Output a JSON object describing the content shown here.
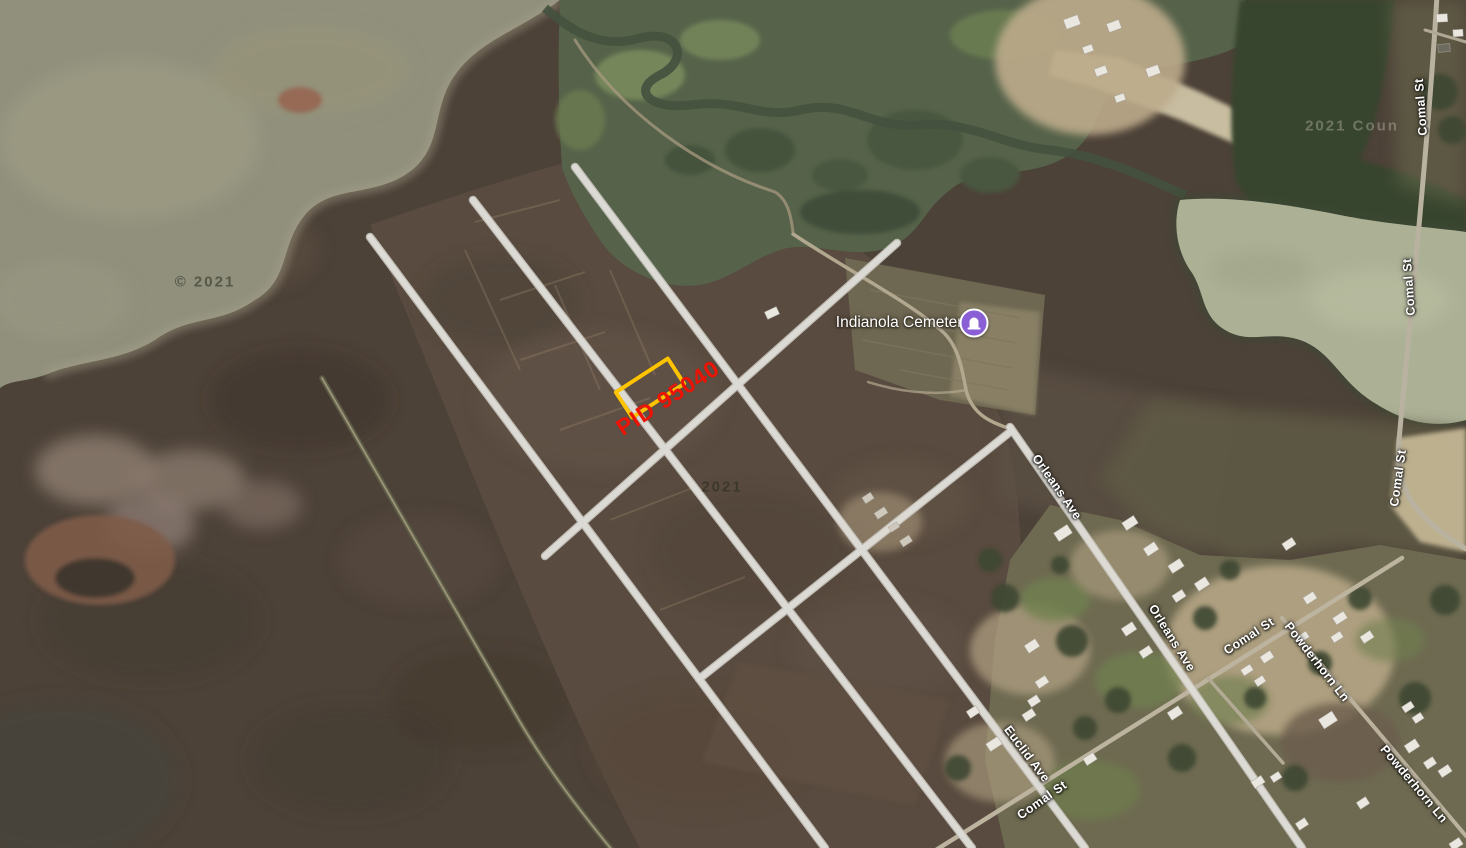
{
  "map": {
    "view": "satellite",
    "parcel": {
      "pid_label": "PID 95040",
      "outline_color": "#ffc400",
      "label_color": "#ee1405"
    },
    "poi": {
      "name": "Indianola Cemetery",
      "icon": "cemetery-icon",
      "icon_color": "#8a5fd6"
    },
    "street_labels": [
      {
        "text": "Comal St",
        "x": 1421,
        "y": 107,
        "rot": -94
      },
      {
        "text": "Comal St",
        "x": 1409,
        "y": 287,
        "rot": -94
      },
      {
        "text": "Comal St",
        "x": 1398,
        "y": 478,
        "rot": -82
      },
      {
        "text": "Orleans Ave",
        "x": 1057,
        "y": 487,
        "rot": 55
      },
      {
        "text": "Orleans Ave",
        "x": 1172,
        "y": 638,
        "rot": 58
      },
      {
        "text": "Comal St",
        "x": 1249,
        "y": 636,
        "rot": -33
      },
      {
        "text": "Powderhorn Ln",
        "x": 1317,
        "y": 662,
        "rot": 52
      },
      {
        "text": "Euclid Ave",
        "x": 1027,
        "y": 754,
        "rot": 53
      },
      {
        "text": "Comal St",
        "x": 1042,
        "y": 800,
        "rot": -35
      },
      {
        "text": "Powderhorn Ln",
        "x": 1414,
        "y": 784,
        "rot": 50
      }
    ],
    "watermarks": [
      {
        "text": "© 2021",
        "x": 205,
        "y": 282,
        "tone": "dark"
      },
      {
        "text": "2021",
        "x": 722,
        "y": 487,
        "tone": "dark"
      },
      {
        "text": "2021 Coun",
        "x": 1352,
        "y": 126,
        "tone": "light"
      }
    ],
    "colors": {
      "road_overlay": "#dedcd6",
      "label_text": "#ffffff",
      "water": "#90907d",
      "marsh": "#4d4238"
    }
  }
}
